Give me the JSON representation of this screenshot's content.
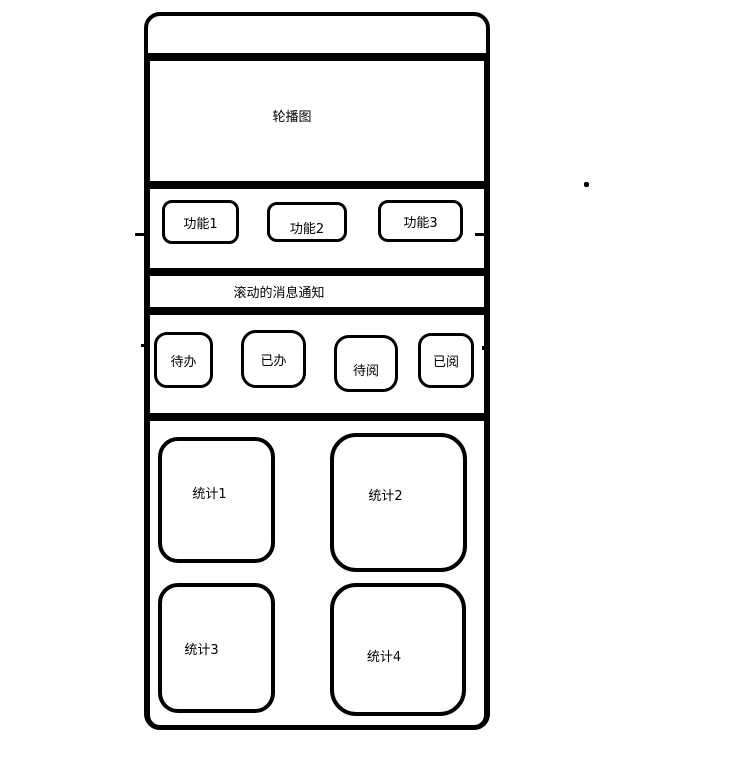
{
  "colors": {
    "stroke": "#000000",
    "background": "#ffffff"
  },
  "wireframe": {
    "carousel": {
      "label": "轮播图"
    },
    "features": {
      "buttons": [
        {
          "label": "功能1"
        },
        {
          "label": "功能2"
        },
        {
          "label": "功能3"
        }
      ]
    },
    "notice": {
      "label": "滚动的消息通知"
    },
    "task_tabs": {
      "buttons": [
        {
          "label": "待办"
        },
        {
          "label": "已办"
        },
        {
          "label": "待阅"
        },
        {
          "label": "已阅"
        }
      ]
    },
    "stats": {
      "cards": [
        {
          "label": "统计1"
        },
        {
          "label": "统计2"
        },
        {
          "label": "统计3"
        },
        {
          "label": "统计4"
        }
      ]
    }
  }
}
